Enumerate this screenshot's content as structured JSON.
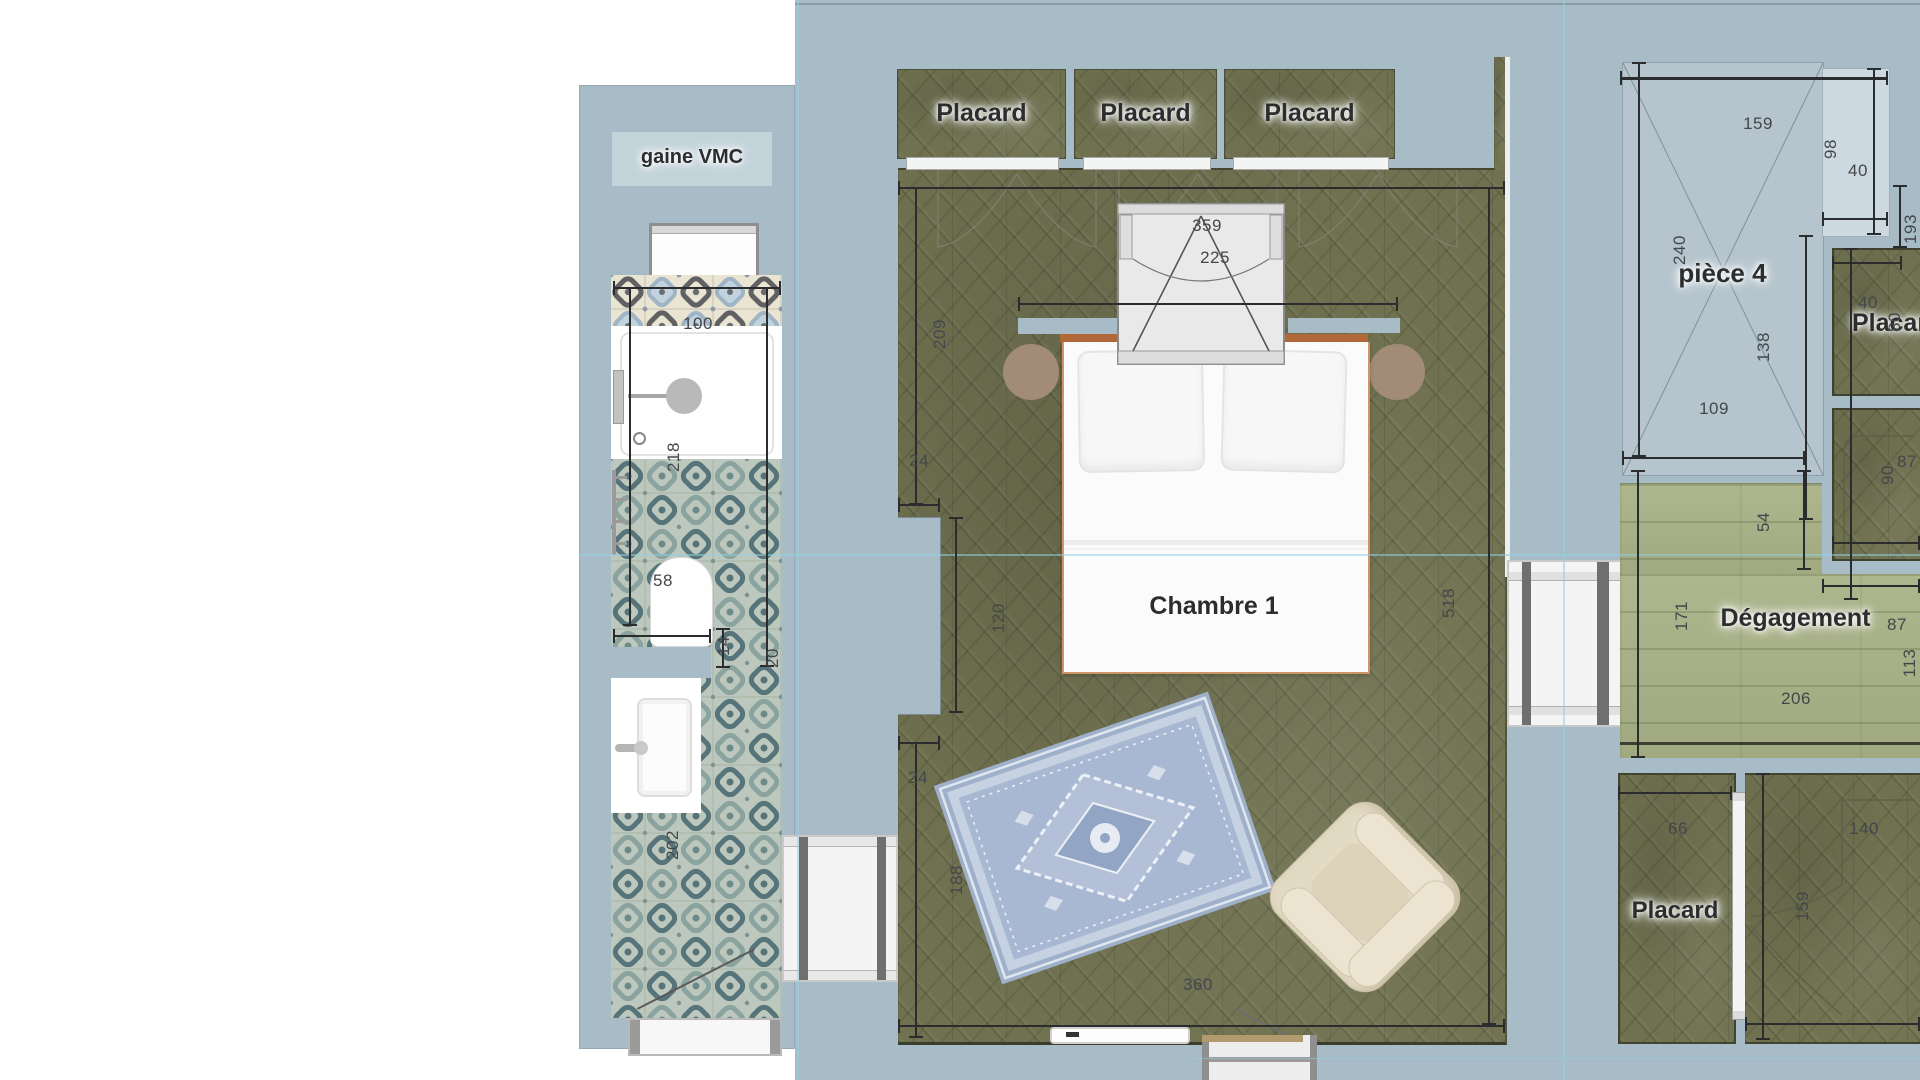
{
  "rooms": {
    "gaine_vmc": "gaine VMC",
    "chambre_1": "Chambre 1",
    "piece_4": "pièce 4",
    "degagement": "Dégagement"
  },
  "closets": {
    "top_1": "Placard",
    "top_2": "Placard",
    "top_3": "Placard",
    "right": "Placard",
    "bottom_left": "Placard"
  },
  "dimensions": {
    "bath_top_width": "100",
    "bath_shower_height": "218",
    "bath_wc_width": "58",
    "bath_gap": "14",
    "bath_side": "20",
    "bath_lower_height": "202",
    "bedroom_left_upper": "209",
    "bedroom_jog_upper": "24",
    "bedroom_opening": "120",
    "bedroom_jog_lower": "24",
    "bedroom_left_lower": "188",
    "bedroom_width": "360",
    "bedroom_height": "518",
    "window_width": "359",
    "window_span": "225",
    "piece4_width": "159",
    "piece4_niche_depth": "98",
    "piece4_niche_width": "40",
    "piece4_height": "240",
    "piece4_diag": "138",
    "piece4_lower_width": "109",
    "piece4_right": "193",
    "closet_tr_width": "40",
    "closet_tr_depth": "80",
    "closet_r2_width": "87",
    "closet_r2_depth": "90",
    "degagement_top": "54",
    "degagement_left": "171",
    "degagement_right": "87",
    "degagement_side": "113",
    "degagement_width": "206",
    "closet_bl_width": "66",
    "closet_br_width": "140",
    "closet_br_depth": "159"
  },
  "colors": {
    "canvas": "#a8bcc7",
    "wood_olive": "#6f7150",
    "wood_sage": "#a9b287",
    "tile_teal": "#5d7b82",
    "tile_cream": "#eae4d2",
    "bed_frame": "#b2693a",
    "room_fill": "#b5c4cd",
    "guide": "#8fd0e2"
  }
}
